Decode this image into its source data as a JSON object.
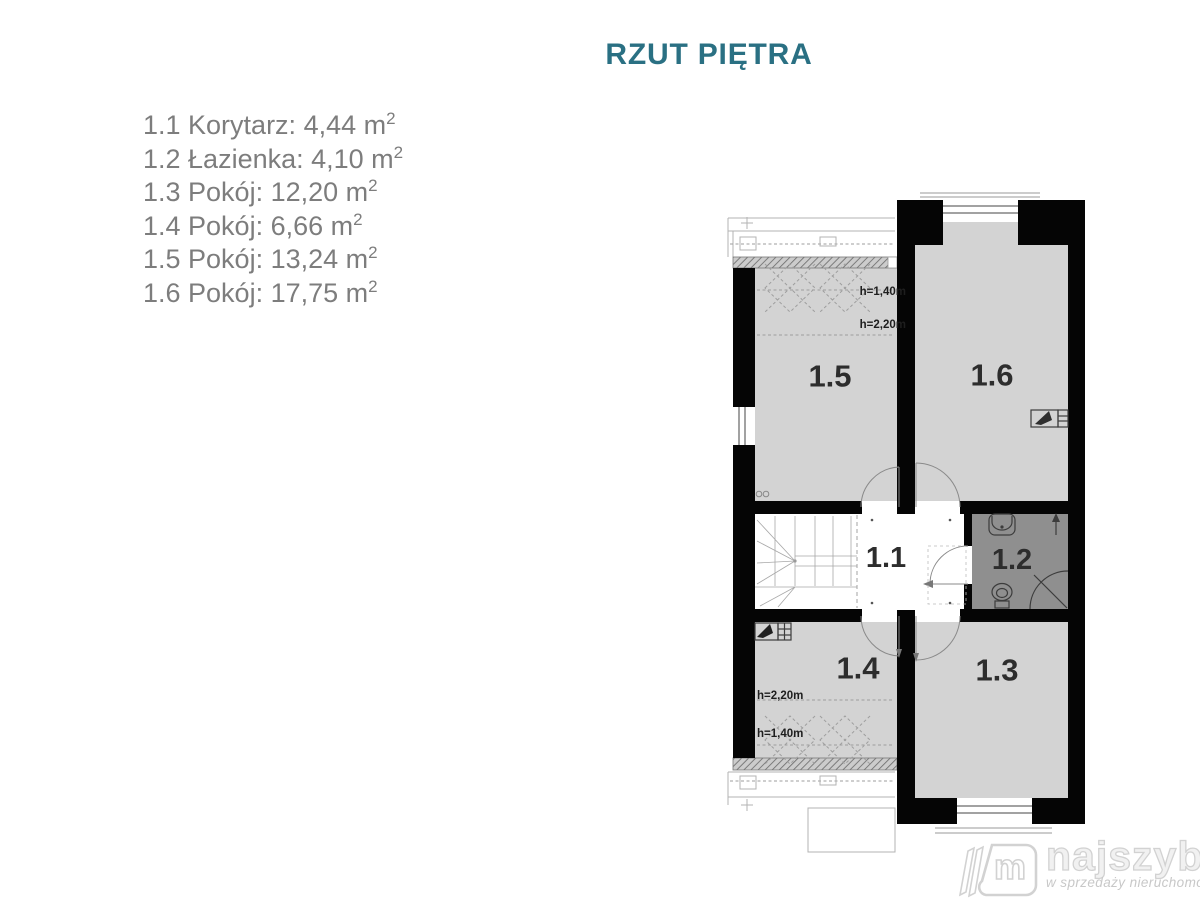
{
  "title": "RZUT PIĘTRA",
  "colors": {
    "title": "#2a7083",
    "list_text": "#7d7d7d",
    "wall": "#050505",
    "room_fill": "#d3d3d3",
    "bath_fill": "#8f8f8f",
    "thin": "#b3b3b3",
    "plan_line": "#3c3c3c",
    "label": "#2d2d2d",
    "dash": "#9e9e9e",
    "wm_stroke": "#d2d2d2",
    "wm_fill": "#f1f1f1",
    "wm_tag": "#c8c8c8"
  },
  "room_list": {
    "items": [
      {
        "text": "1.1 Korytarz: 4,44 m",
        "sup": "2"
      },
      {
        "text": "1.2 Łazienka: 4,10 m",
        "sup": "2"
      },
      {
        "text": "1.3 Pokój: 12,20 m",
        "sup": "2"
      },
      {
        "text": "1.4 Pokój: 6,66 m",
        "sup": "2"
      },
      {
        "text": "1.5 Pokój: 13,24 m",
        "sup": "2"
      },
      {
        "text": "1.6 Pokój: 17,75 m",
        "sup": "2"
      }
    ]
  },
  "plan": {
    "room_labels": {
      "r11": "1.1",
      "r12": "1.2",
      "r13": "1.3",
      "r14": "1.4",
      "r15": "1.5",
      "r16": "1.6"
    },
    "height_labels": {
      "top_upper": "h=1,40m",
      "top_lower": "h=2,20m",
      "bottom_upper": "h=2,20m",
      "bottom_lower": "h=1,40m"
    }
  },
  "logo": {
    "brand": "najszybsi",
    "tagline": "w sprzedaży nieruchomości"
  }
}
